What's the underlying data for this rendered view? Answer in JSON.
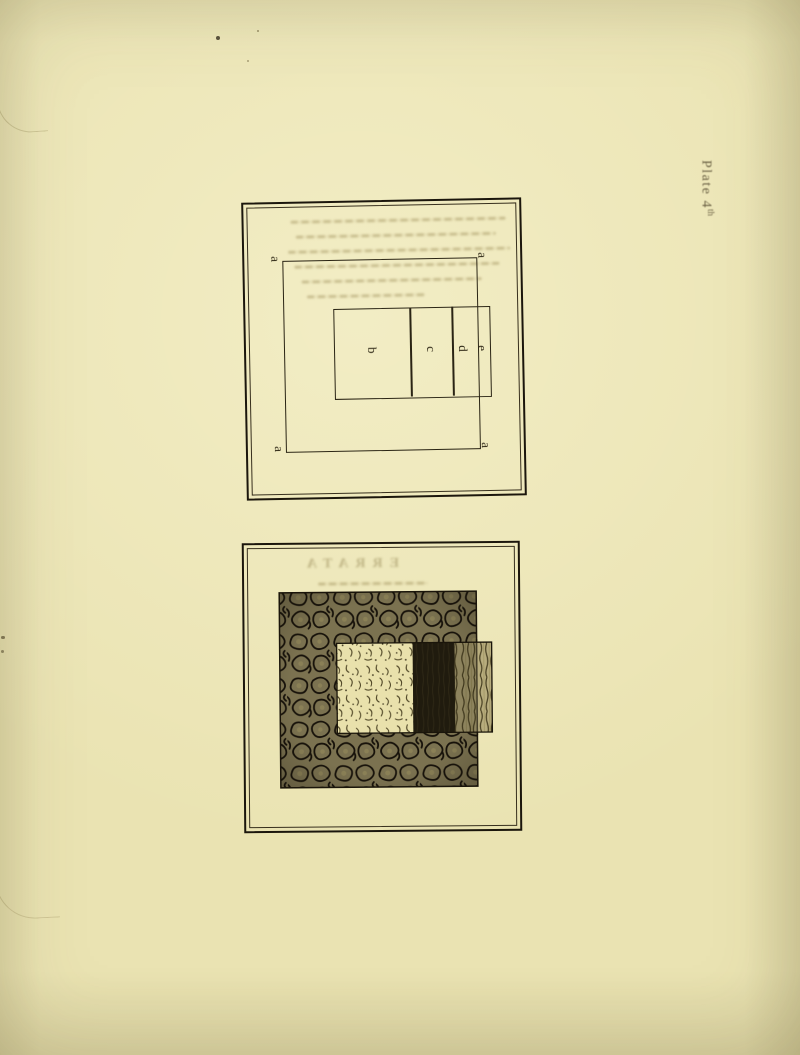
{
  "page": {
    "caption": {
      "text": "Plate 4",
      "superscript": "th"
    },
    "paper_color": "#eae3b2",
    "ink_color": "#1b160c"
  },
  "figure1": {
    "description": "line diagram: large square lettered a at its four corners, overlapped by a horizontal rectangle divided into sections b, c, d, e; section e projects beyond the right side of the square",
    "corner_labels": [
      "a",
      "a",
      "a",
      "a"
    ],
    "section_labels": [
      "b",
      "c",
      "d",
      "e"
    ]
  },
  "figure2": {
    "description": "shaded version of the same construction: dark vermicular-textured square overlapped by a rectangle with stippled light, solid black and striated sections, the striated end projecting past the square",
    "textures": [
      "vermicular-dark",
      "stipple-light",
      "solid-black",
      "striated"
    ],
    "texture_colors": {
      "vermicular_base": "#7b7250",
      "stipple_base": "#e9e1ac",
      "black": "#201b0e",
      "striated_base": "#b8ad7e"
    }
  },
  "ghost": {
    "heading": "ERRATA"
  }
}
